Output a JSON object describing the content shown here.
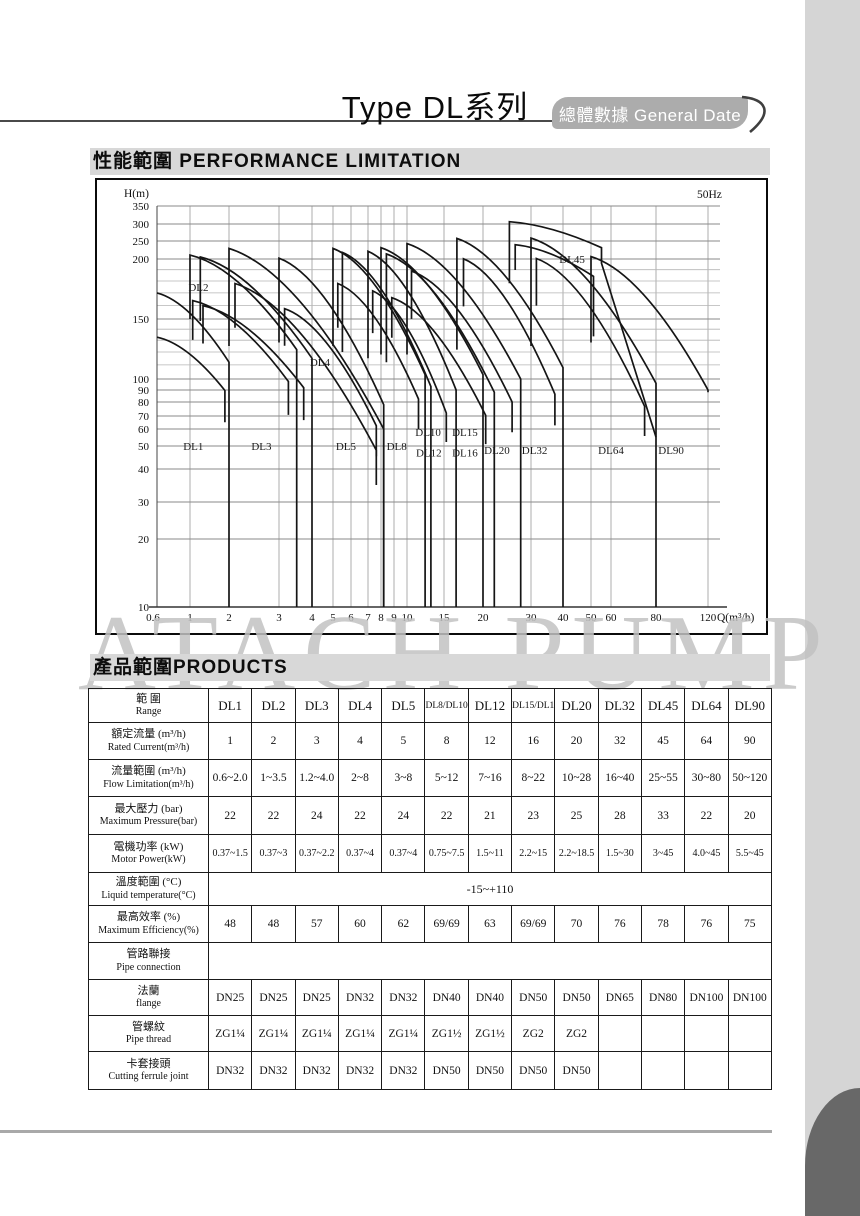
{
  "page": {
    "title": "Type DL系列",
    "tab_label": "總體數據 General Date",
    "section_performance": "性能範圍 PERFORMANCE LIMITATION",
    "section_products": "產品範圍PRODUCTS",
    "watermark": "ATACH PUMP"
  },
  "colors": {
    "section_bar_bg": "#d8d8d8",
    "tab_bg": "#acacac",
    "tab_text": "#ffffff",
    "watermark": "#c2c2c2",
    "page_edge_strip": "#d5d5d5",
    "page_corner": "#686868",
    "curve_stroke": "#151515"
  },
  "chart_data": {
    "type": "area",
    "title": "",
    "frequency_label": "50Hz",
    "ylabel": "H(m)",
    "xlabel": "Q(m³/h)",
    "xlim": [
      0.6,
      140
    ],
    "ylim": [
      10,
      350
    ],
    "grid": true,
    "x_ticks": [
      0.6,
      1,
      2,
      3,
      4,
      5,
      6,
      7,
      8,
      9,
      10,
      15,
      20,
      30,
      40,
      50,
      60,
      80,
      120
    ],
    "x_tick_labels": [
      "0.6",
      "1",
      "2",
      "3",
      "4",
      "5",
      "6",
      "7",
      "8",
      "9",
      "10",
      "15",
      "20",
      "30",
      "40",
      "50",
      "60",
      "80",
      "120"
    ],
    "y_ticks": [
      10,
      20,
      30,
      40,
      50,
      60,
      70,
      80,
      90,
      100,
      150,
      200,
      250,
      300,
      350
    ],
    "y_tick_labels": [
      "10",
      "20",
      "30",
      "40",
      "50",
      "60",
      "70",
      "80",
      "90",
      "100",
      "150",
      "200",
      "250",
      "300",
      "350"
    ],
    "y_grid": [
      20,
      30,
      40,
      50,
      60,
      70,
      80,
      90,
      100,
      110,
      120,
      130,
      140,
      150,
      160,
      170,
      180,
      190,
      200,
      250,
      300,
      350
    ],
    "series": [
      {
        "name": "DL1",
        "qmin": 0.62,
        "qmax": 2,
        "peak": 170,
        "knee": 112,
        "lvb": 170,
        "rvb": 10,
        "from_axis": true
      },
      {
        "name": "DL2",
        "qmin": 1,
        "qmax": 3.5,
        "peak": 210,
        "knee": 122,
        "lvb": 150,
        "rvb": 10
      },
      {
        "name": "DL3",
        "qmin": 1.2,
        "qmax": 4,
        "peak": 205,
        "knee": 115,
        "lvb": 148,
        "rvb": 10
      },
      {
        "name": "DL4",
        "qmin": 2,
        "qmax": 8.2,
        "peak": 228,
        "knee": 60,
        "lvb": 125,
        "rvb": 10
      },
      {
        "name": "DL5",
        "qmin": 3,
        "qmax": 8.2,
        "peak": 202,
        "knee": 78,
        "lvb": 128,
        "rvb": 10
      },
      {
        "name": "DL8",
        "qmin": 5,
        "qmax": 12.2,
        "peak": 228,
        "knee": 103,
        "lvb": 125,
        "rvb": 10
      },
      {
        "name": "DL10",
        "qmin": 5.5,
        "qmax": 13,
        "peak": 217,
        "knee": 93,
        "lvb": 120,
        "rvb": 10,
        "inner": false
      },
      {
        "name": "DL12",
        "qmin": 7,
        "qmax": 16.4,
        "peak": 220,
        "knee": 90,
        "lvb": 115,
        "rvb": 10
      },
      {
        "name": "DL15",
        "qmin": 8,
        "qmax": 20,
        "peak": 230,
        "knee": 103,
        "lvb": 118,
        "rvb": 10,
        "inner": false
      },
      {
        "name": "DL16",
        "qmin": 8.4,
        "qmax": 22,
        "peak": 213,
        "knee": 88,
        "lvb": 112,
        "rvb": 10
      },
      {
        "name": "DL20",
        "qmin": 10,
        "qmax": 27.5,
        "peak": 242,
        "knee": 100,
        "lvb": 118,
        "rvb": 10
      },
      {
        "name": "DL32",
        "qmin": 16.5,
        "qmax": 40,
        "peak": 257,
        "knee": 108,
        "lvb": 122,
        "rvb": 10
      },
      {
        "name": "DL45",
        "qmin": 25,
        "qmax": 55,
        "peak": 306,
        "knee": 230,
        "lvb": 178,
        "rvb": 196,
        "tail": {
          "q": 80,
          "h": 55
        }
      },
      {
        "name": "DL64",
        "qmin": 30,
        "qmax": 80,
        "peak": 258,
        "knee": 96,
        "lvb": 125,
        "rvb": 10
      },
      {
        "name": "DL90",
        "qmin": 50,
        "qmax": 120,
        "peak": 206,
        "knee": 90,
        "lvb": 128,
        "rvb": 88,
        "inner": false
      }
    ],
    "region_labels": [
      {
        "text": "DL1",
        "q": 1.06,
        "h": 50
      },
      {
        "text": "DL2",
        "q": 1.16,
        "h": 175
      },
      {
        "text": "DL3",
        "q": 2.6,
        "h": 50
      },
      {
        "text": "DL4",
        "q": 4.35,
        "h": 112
      },
      {
        "text": "DL5",
        "q": 5.7,
        "h": 50
      },
      {
        "text": "DL8",
        "q": 9.2,
        "h": 50
      },
      {
        "text": "DL10",
        "q": 12.6,
        "h": 58
      },
      {
        "text": "DL12",
        "q": 12.7,
        "h": 47
      },
      {
        "text": "DL15",
        "q": 17.5,
        "h": 58
      },
      {
        "text": "DL16",
        "q": 17.5,
        "h": 47
      },
      {
        "text": "DL20",
        "q": 22.5,
        "h": 48
      },
      {
        "text": "DL32",
        "q": 31,
        "h": 48
      },
      {
        "text": "DL45",
        "q": 43,
        "h": 200
      },
      {
        "text": "DL64",
        "q": 60,
        "h": 48
      },
      {
        "text": "DL90",
        "q": 90,
        "h": 48
      }
    ]
  },
  "table": {
    "header": {
      "zh": "範  圍",
      "en": "Range"
    },
    "columns": [
      "DL1",
      "DL2",
      "DL3",
      "DL4",
      "DL5",
      "DL8/DL10",
      "DL12",
      "DL15/DL16",
      "DL20",
      "DL32",
      "DL45",
      "DL64",
      "DL90"
    ],
    "rows": [
      {
        "zh": "額定流量 (m³/h)",
        "en": "Rated Current(m³/h)",
        "cells": [
          "1",
          "2",
          "3",
          "4",
          "5",
          "8",
          "12",
          "16",
          "20",
          "32",
          "45",
          "64",
          "90"
        ]
      },
      {
        "zh": "流量範圍 (m³/h)",
        "en": "Flow Limitation(m³/h)",
        "cells": [
          "0.6~2.0",
          "1~3.5",
          "1.2~4.0",
          "2~8",
          "3~8",
          "5~12",
          "7~16",
          "8~22",
          "10~28",
          "16~40",
          "25~55",
          "30~80",
          "50~120"
        ]
      },
      {
        "zh": "最大壓力 (bar)",
        "en": "Maximum Pressure(bar)",
        "cells": [
          "22",
          "22",
          "24",
          "22",
          "24",
          "22",
          "21",
          "23",
          "25",
          "28",
          "33",
          "22",
          "20"
        ]
      },
      {
        "zh": "電機功率 (kW)",
        "en": "Motor Power(kW)",
        "tight": true,
        "cells": [
          "0.37~1.5",
          "0.37~3",
          "0.37~2.2",
          "0.37~4",
          "0.37~4",
          "0.75~7.5",
          "1.5~11",
          "2.2~15",
          "2.2~18.5",
          "1.5~30",
          "3~45",
          "4.0~45",
          "5.5~45"
        ]
      },
      {
        "zh": "溫度範圍 (°C)",
        "en": "Liquid temperature(°C)",
        "merged": "-15~+110"
      },
      {
        "zh": "最高效率 (%)",
        "en": "Maximum Efficiency(%)",
        "cells": [
          "48",
          "48",
          "57",
          "60",
          "62",
          "69/69",
          "63",
          "69/69",
          "70",
          "76",
          "78",
          "76",
          "75"
        ]
      },
      {
        "zh": "管路聯接",
        "en": "Pipe connection",
        "merged": ""
      },
      {
        "zh": "法蘭",
        "en": "flange",
        "cells": [
          "DN25",
          "DN25",
          "DN25",
          "DN32",
          "DN32",
          "DN40",
          "DN40",
          "DN50",
          "DN50",
          "DN65",
          "DN80",
          "DN100",
          "DN100"
        ]
      },
      {
        "zh": "管螺紋",
        "en": "Pipe thread",
        "cells": [
          "ZG1¼",
          "ZG1¼",
          "ZG1¼",
          "ZG1¼",
          "ZG1¼",
          "ZG1½",
          "ZG1½",
          "ZG2",
          "ZG2",
          "",
          "",
          "",
          ""
        ]
      },
      {
        "zh": "卡套接頭",
        "en": "Cutting ferrule joint",
        "cells": [
          "DN32",
          "DN32",
          "DN32",
          "DN32",
          "DN32",
          "DN50",
          "DN50",
          "DN50",
          "DN50",
          "",
          "",
          "",
          ""
        ]
      }
    ]
  }
}
